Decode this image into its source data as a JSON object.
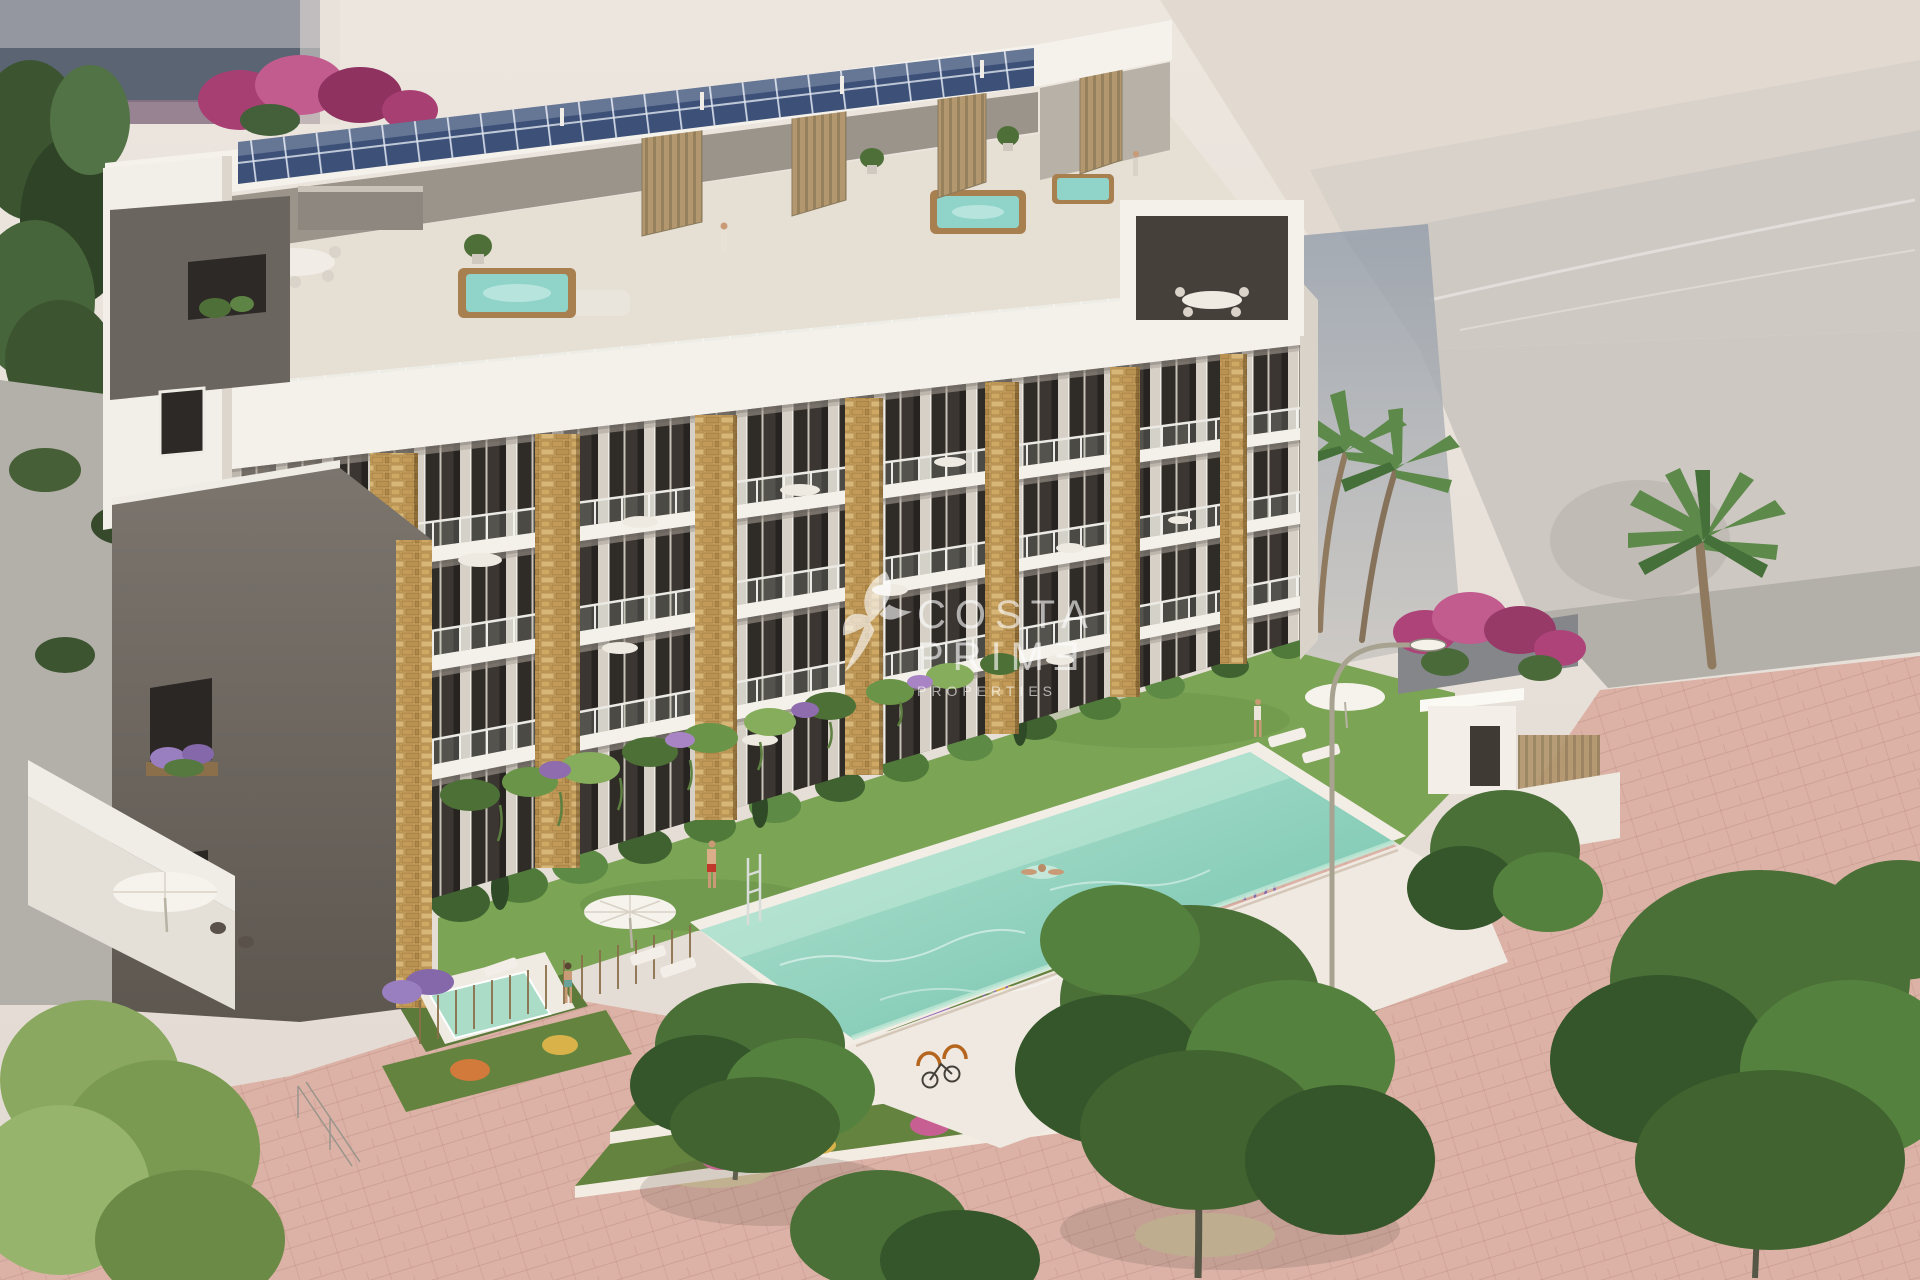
{
  "watermark": {
    "logo": "hummingbird-icon",
    "line1": "COSTA",
    "line2": "PRIMƎ",
    "line3": "PROPERTIES"
  },
  "scene": {
    "type": "architectural-render",
    "subject": "Aerial view of a modern white apartment building with rooftop solar panels, jacuzzi roof terraces, stone-clad pillars, planted balconies, communal lawn with infinity pool, terraced flower beds, pink promenade, palm trees and pedestrians",
    "elements": [
      "solar-panel-roof",
      "rooftop-terraces",
      "jacuzzis",
      "stone-pillars",
      "balcony-floors",
      "hanging-gardens",
      "lavender-window-boxes",
      "hedge-and-glass-fence",
      "lawn",
      "infinity-pool",
      "swimmer",
      "sun-loungers",
      "parasols",
      "plunge-pool",
      "street-lamp",
      "flower-terraces",
      "bike-racks",
      "pink-promenade",
      "palm-trees",
      "pedestrians",
      "background-buildings",
      "bougainvillea"
    ]
  },
  "palette": {
    "sky": "#eae3db",
    "bg-build": "#e2dad1",
    "bg-slab": "#d8d2cb",
    "bg-slab2": "#cfc9c3",
    "shadow-blue": "#98a1ad",
    "dark-build": "#5a6472",
    "dark-build-top": "#9496a0",
    "mauve": "#8a7286",
    "white-wall": "#f4f1ea",
    "wall-shade": "#d8d2c9",
    "recess": "#423c36",
    "stone": "#c9a25e",
    "solar": "#3c5078",
    "green-dark": "#3a5230",
    "green": "#55793f",
    "green-light": "#79a355",
    "hedge": "#4a7038",
    "lawn": "#7ba455",
    "pool": "#7cc8b4",
    "pool-light": "#b2e2d0",
    "deck": "#efe9e1",
    "pave": "#dcb2a6",
    "gravel": "#b3afa9",
    "flower-purple": "#9a6fb5",
    "flower-pink": "#d76f9f",
    "flower-orange": "#d2793c",
    "flower-yellow": "#d9b34a",
    "bougainvillea": "#ae4379",
    "wood": "#a87f4f",
    "trunk": "#8f7a5f",
    "skin": "#c89b76",
    "jeans": "#5b7390",
    "red-shorts": "#c0392b",
    "watermark": "#ffffff"
  }
}
